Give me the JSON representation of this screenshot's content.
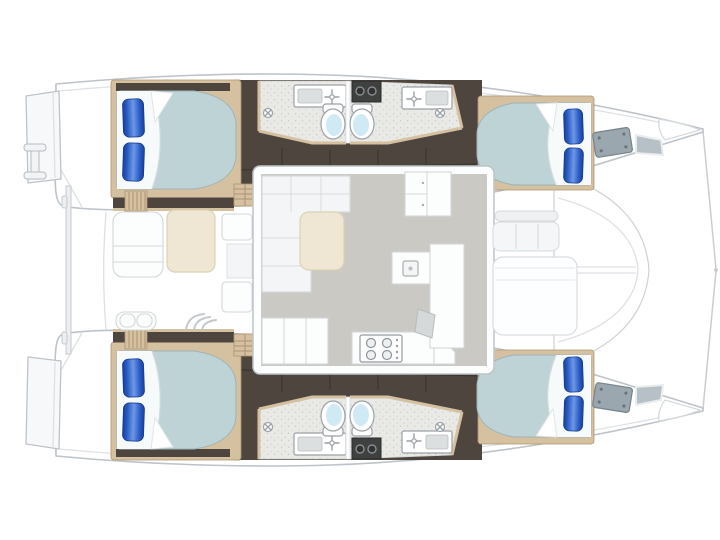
{
  "image": {
    "description": "Catamaran yacht deck floor plan, top-down view, bows pointing right",
    "view": "plan"
  },
  "palette": {
    "bg": "#ffffff",
    "hull_fill": "#ffffff",
    "hull_stroke": "#bdc3c9",
    "seam": "#dde1e5",
    "platform": "#f7f8f9",
    "dark_floor": "#4e463e",
    "dark_floor_seam": "#3b352e",
    "wood": "#d5c1a0",
    "wood_dark": "#ac9472",
    "bath_floor": "#e9e9e6",
    "speckle_dot": "#c8c9c5",
    "mattress": "#bed3d6",
    "mattress_stroke": "#9db3b7",
    "sheet": "#f6fafb",
    "pillow_edge": "#17409c",
    "pillow_mid": "#2a5cc4",
    "pillow_light": "#6e97e6",
    "toilet_bowl": "#cfe9f5",
    "fixture_stroke": "#9aa1a7",
    "saloon_floor": "#cac9c4",
    "sofa": "#f3f5f6",
    "sofa_stroke": "#d8dbdd",
    "table_cream": "#efe7d3",
    "table_stroke": "#dbd1b6",
    "counter_white": "#fcfdfd",
    "counter_stroke": "#d3d6d9",
    "hatch_gray": "#9aa7ae",
    "hatch_stroke": "#76838b",
    "window_gray": "#b6c0c6",
    "utility_dark": "#3f4040"
  },
  "vessel": {
    "type": "sailing catamaran",
    "hulls": [
      "port hull",
      "starboard hull"
    ],
    "cabins": [
      {
        "name": "aft cabin port",
        "features": [
          "double bed",
          "2 blue pillows",
          "entry steps"
        ]
      },
      {
        "name": "forward cabin port",
        "features": [
          "double bed",
          "2 blue pillows",
          "bow deck hatch",
          "hull window"
        ]
      },
      {
        "name": "aft cabin starboard",
        "features": [
          "double bed",
          "2 blue pillows",
          "entry steps"
        ]
      },
      {
        "name": "forward cabin starboard",
        "features": [
          "double bed",
          "2 blue pillows",
          "bow deck hatch",
          "hull window"
        ]
      }
    ],
    "heads": [
      {
        "name": "port aft head",
        "fixtures": [
          "sink",
          "toilet",
          "shower drain"
        ]
      },
      {
        "name": "port forward head",
        "fixtures": [
          "sink",
          "toilet",
          "shower drain"
        ]
      },
      {
        "name": "starboard aft head",
        "fixtures": [
          "sink",
          "toilet",
          "shower drain"
        ]
      },
      {
        "name": "starboard forward head",
        "fixtures": [
          "sink",
          "toilet",
          "shower drain"
        ]
      }
    ],
    "common_areas": [
      "saloon with L-shaped sofa and table",
      "galley with 4-burner stove, sink island and cabinets",
      "aft cockpit with table, benches and steps",
      "forward cockpit with bench and lounge pad",
      "foredeck",
      "twin swim platforms with stern ladder"
    ],
    "counts": {
      "double_beds": 4,
      "pillows": 8,
      "toilets": 4,
      "head_sinks": 4,
      "shower_drains": 4,
      "stove_burners": 4,
      "bow_hatches": 2
    }
  }
}
